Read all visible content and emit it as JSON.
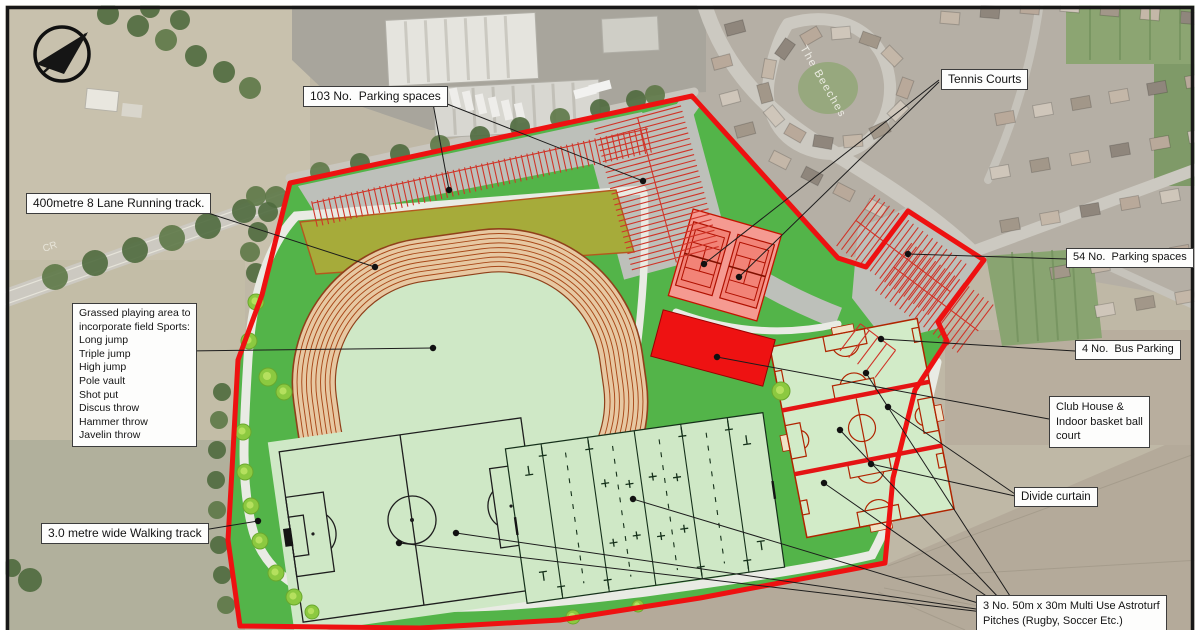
{
  "callouts": {
    "parking_103": "103 No.  Parking spaces",
    "tennis_courts": "Tennis Courts",
    "running_track": "400metre 8 Lane Running track.",
    "parking_54": "54 No.  Parking spaces",
    "bus_parking": "4 No.  Bus Parking",
    "grassed_area_lines": [
      "Grassed playing area to",
      "incorporate field Sports:",
      "Long jump",
      "Triple jump",
      "High jump",
      "Pole vault",
      "Shot put",
      "Discus throw",
      "Hammer throw",
      "Javelin throw"
    ],
    "club_house_lines": [
      "Club House &",
      "Indoor basket ball",
      "court"
    ],
    "divide_curtain": "Divide curtain",
    "walking_track": "3.0 metre wide Walking track",
    "astroturf_lines": [
      "3 No. 50m x 30m Multi Use Astroturf",
      "Pitches (Rugby, Soccer Etc.)"
    ]
  },
  "map_texts": {
    "street_name": "The Beeches",
    "road_label": "CR"
  },
  "icons": {
    "north_arrow": "north-arrow"
  },
  "colors": {
    "site_boundary": "#ee1111",
    "site_grass": "#53b449",
    "pitch_surface": "#cfe8c6",
    "track_surface": "#e7c8a2",
    "track_lane_lines": "#a84818",
    "pitch_markings_red": "#b02400",
    "divide_curtain_red": "#e41414",
    "tennis_surface": "#f59a91",
    "club_house_red": "#ee1212",
    "parking_hatch": "#d03428",
    "walking_path": "#e9ebe4",
    "grassed_bank": "#a6ab3a"
  }
}
